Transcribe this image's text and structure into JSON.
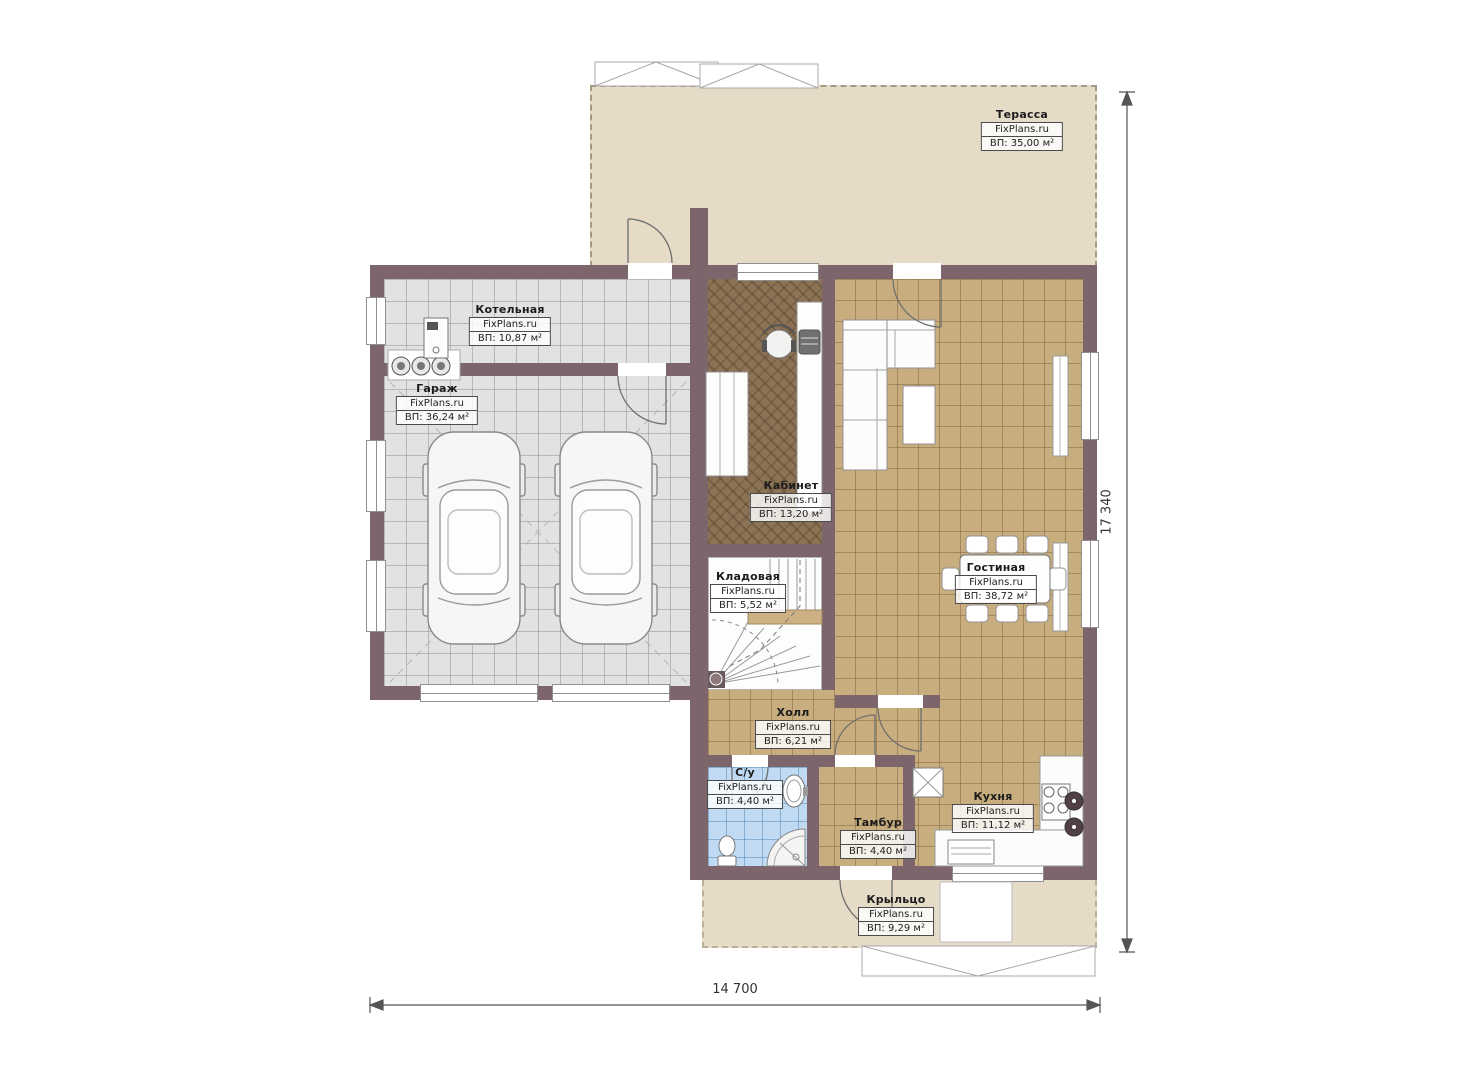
{
  "brand": "FixPlans.ru",
  "rooms": [
    {
      "name": "Терасса",
      "area": "ВП: 35,00 м²"
    },
    {
      "name": "Котельная",
      "area": "ВП: 10,87 м²"
    },
    {
      "name": "Гараж",
      "area": "ВП: 36,24 м²"
    },
    {
      "name": "Кабинет",
      "area": "ВП: 13,20 м²"
    },
    {
      "name": "Кладовая",
      "area": "ВП: 5,52 м²"
    },
    {
      "name": "Гостиная",
      "area": "ВП: 38,72 м²"
    },
    {
      "name": "Холл",
      "area": "ВП: 6,21 м²"
    },
    {
      "name": "С/у",
      "area": "ВП: 4,40 м²"
    },
    {
      "name": "Тамбур",
      "area": "ВП: 4,40 м²"
    },
    {
      "name": "Кухня",
      "area": "ВП: 11,12 м²"
    },
    {
      "name": "Крыльцо",
      "area": "ВП: 9,29 м²"
    }
  ],
  "dimensions": {
    "width": "14 700",
    "height": "17 340"
  },
  "colors": {
    "wall": "#7c666b",
    "terrace_floor": "#e5dbc7",
    "garage_floor": "#e2e2e2",
    "living_floor": "#c8ad7f",
    "office_floor": "#8c7355",
    "bath_floor": "#bfdaf2"
  }
}
